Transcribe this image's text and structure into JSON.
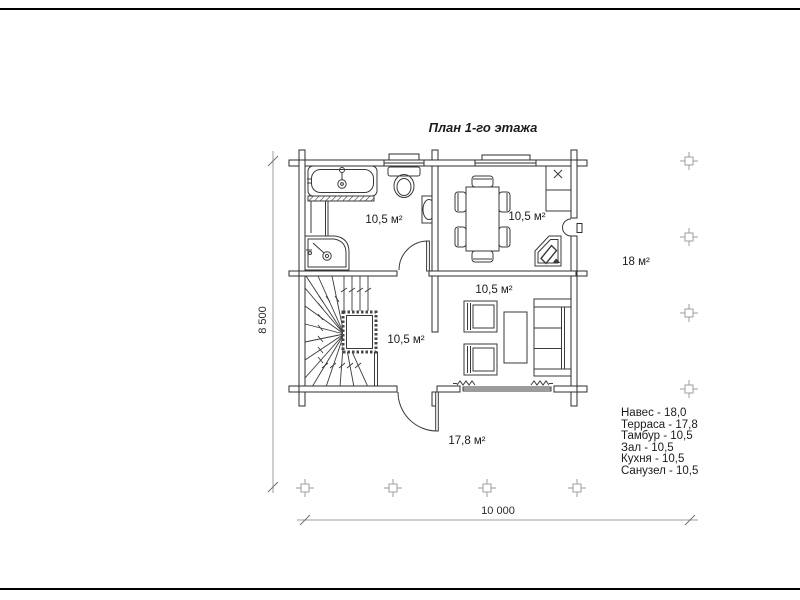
{
  "title": "План 1-го этажа",
  "labels": {
    "bathroom": "10,5 м²",
    "kitchen": "10,5 м²",
    "hall": "10,5 м²",
    "tambour": "10,5 м²",
    "terrace": "17,8 м²",
    "canopy": "18 м²"
  },
  "dimensions": {
    "width": "10 000",
    "height": "8 500"
  },
  "legend": {
    "items": [
      "Навес - 18,0",
      "Терраса - 17,8",
      "Тамбур - 10,5",
      "Зал - 10,5",
      "Кухня - 10,5",
      "Санузел - 10,5"
    ]
  },
  "colors": {
    "ink": "#3a3a3a",
    "wall": "#2e2e2e",
    "dim": "#9e9e9e",
    "text": "#1b1b1b",
    "background": "#ffffff"
  }
}
